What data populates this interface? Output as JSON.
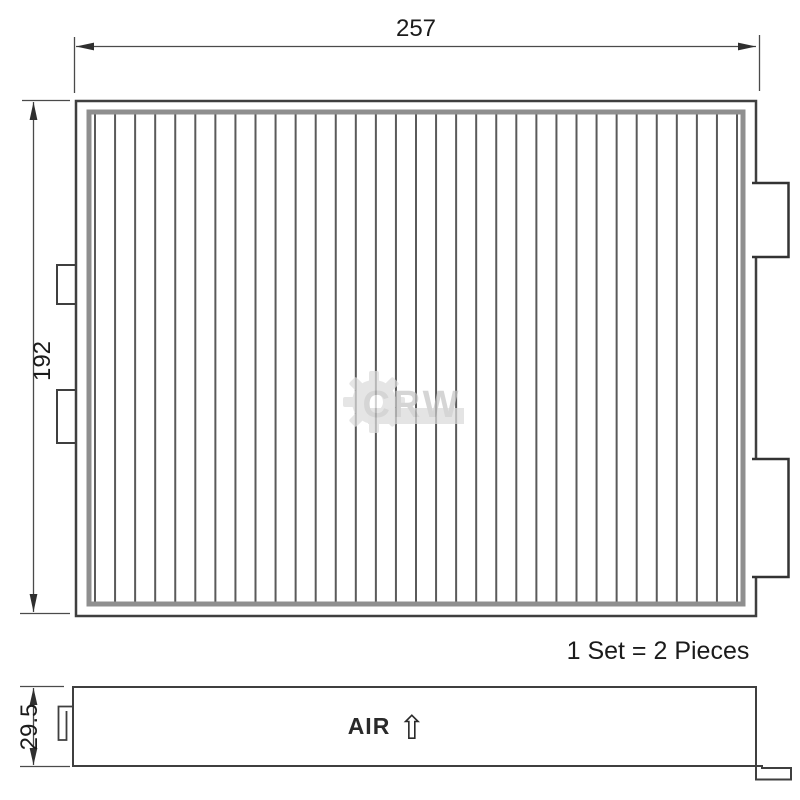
{
  "drawing": {
    "dimension_width": "257",
    "dimension_height": "192",
    "dimension_thickness": "29.5",
    "set_note": "1 Set = 2 Pieces",
    "air_label": "AIR",
    "air_arrow_icon": "⇧",
    "watermark_text": "CRW",
    "pleat_count": 33,
    "colors": {
      "line": "#3f3f3f",
      "frame_inner": "#8f8f8f",
      "pleat": "#5a5a5a",
      "text": "#1b1b1b",
      "watermark": "#c6c6c6"
    }
  }
}
